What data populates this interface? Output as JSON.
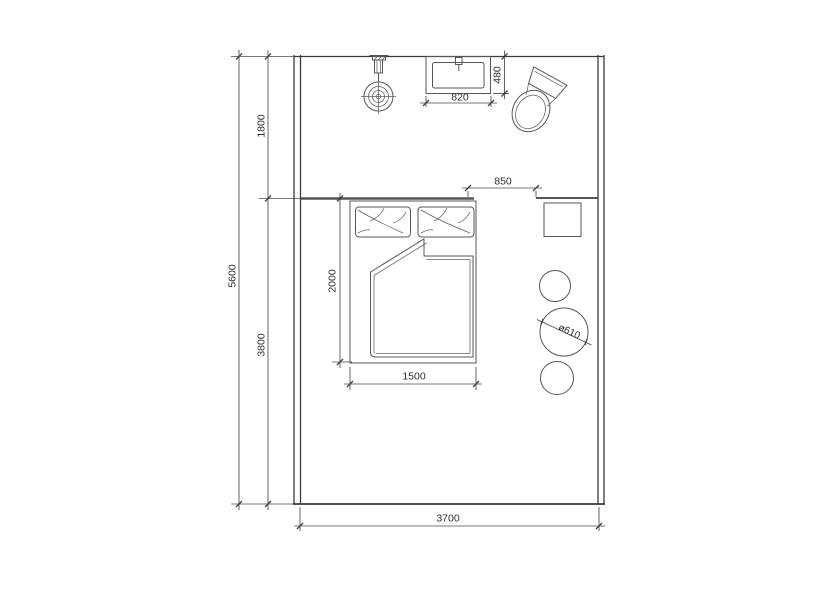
{
  "drawing": {
    "kind": "floor-plan",
    "colors": {
      "background": "#ffffff",
      "wall_line": "#3a3a3a",
      "furniture_line": "#565656",
      "dimension_line": "#4a4a4a",
      "text": "#2d2d2d"
    },
    "fixtures": [
      "pendant-light",
      "vanity-sink",
      "toilet",
      "double-bed",
      "pillows",
      "duvet",
      "nightstand",
      "round-stools"
    ]
  },
  "dims": {
    "overall_height": "5600",
    "upper_zone": "1800",
    "lower_zone": "3800",
    "room_width": "3700",
    "bed_length": "2000",
    "bed_width": "1500",
    "vanity_width": "820",
    "vanity_depth": "480",
    "opening": "850",
    "stool_diameter": "ø610"
  }
}
